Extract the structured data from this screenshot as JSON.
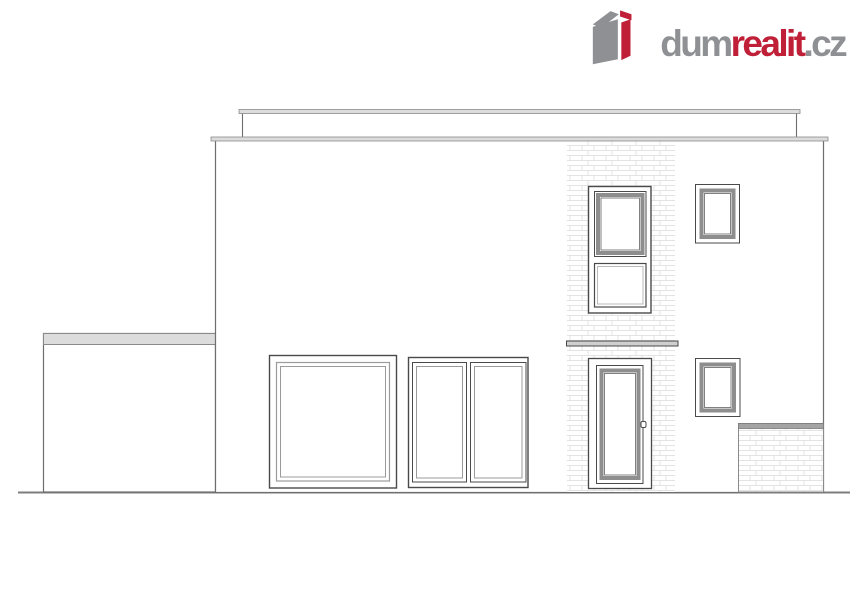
{
  "logo": {
    "dum": "dum",
    "realit": "realit",
    "cz": ".cz",
    "icon_name": "dumrealit-3d-house-cube-icon"
  },
  "watermark": {
    "text": "dumrealit.cz"
  },
  "colors": {
    "brand_red": "#c02037",
    "brand_gray": "#8e9094",
    "outline": "#6e6e6e",
    "frame_dark": "#4a4a4a",
    "frame_gray": "#8e8e8e",
    "band_light": "#dcdcdc",
    "band_mid": "#a4a4a4",
    "brick_line": "#e3e3e3",
    "ground": "#7d7d7d",
    "watermark_gray": "#8e9094"
  }
}
